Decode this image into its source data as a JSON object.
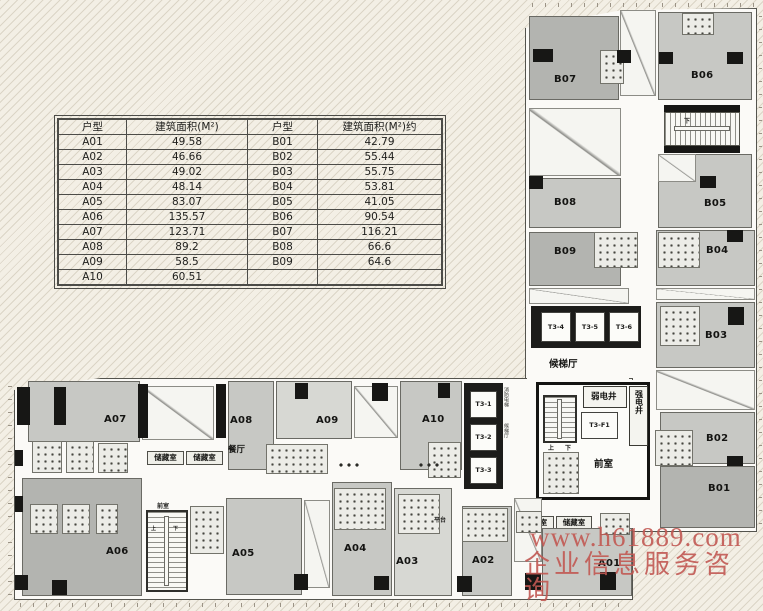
{
  "colors": {
    "background": "#f3efe5",
    "watermark": "#c1584f",
    "room_dark": "#b3b4b0",
    "room_mid": "#c7c8c4",
    "room_light": "#d7d8d3",
    "wall": "#171715"
  },
  "table": {
    "headers": [
      "户型",
      "建筑面积(M²)",
      "户型",
      "建筑面积(M²)约"
    ],
    "rows": [
      [
        "A01",
        "49.58",
        "B01",
        "42.79"
      ],
      [
        "A02",
        "46.66",
        "B02",
        "55.44"
      ],
      [
        "A03",
        "49.02",
        "B03",
        "55.75"
      ],
      [
        "A04",
        "48.14",
        "B04",
        "53.81"
      ],
      [
        "A05",
        "83.07",
        "B05",
        "41.05"
      ],
      [
        "A06",
        "135.57",
        "B06",
        "90.54"
      ],
      [
        "A07",
        "123.71",
        "B07",
        "116.21"
      ],
      [
        "A08",
        "89.2",
        "B08",
        "66.6"
      ],
      [
        "A09",
        "58.5",
        "B09",
        "64.6"
      ],
      [
        "A10",
        "60.51",
        "",
        ""
      ]
    ]
  },
  "plan": {
    "units": {
      "A01": "A01",
      "A02": "A02",
      "A03": "A03",
      "A04": "A04",
      "A05": "A05",
      "A06": "A06",
      "A07": "A07",
      "A08": "A08",
      "A09": "A09",
      "A10": "A10",
      "B01": "B01",
      "B02": "B02",
      "B03": "B03",
      "B04": "B04",
      "B05": "B05",
      "B06": "B06",
      "B07": "B07",
      "B08": "B08",
      "B09": "B09"
    },
    "lifts": {
      "t3_1": "T3-1",
      "t3_2": "T3-2",
      "t3_3": "T3-3",
      "t3_4": "T3-4",
      "t3_5": "T3-5",
      "t3_6": "T3-6",
      "t3_f1": "T3-F1"
    },
    "rooms": {
      "dining": "餐厅",
      "storage": "储藏室",
      "lift_lobby": "候梯厅",
      "weak_shaft": "弱电井",
      "strong_shaft": "强电井",
      "front_room": "前室",
      "platform": "平台",
      "up": "上",
      "down": "下",
      "fire_lift_note": "消防电梯"
    }
  },
  "watermark": {
    "line1": "www.h61889.com",
    "line2": "企业信息服务咨询"
  }
}
